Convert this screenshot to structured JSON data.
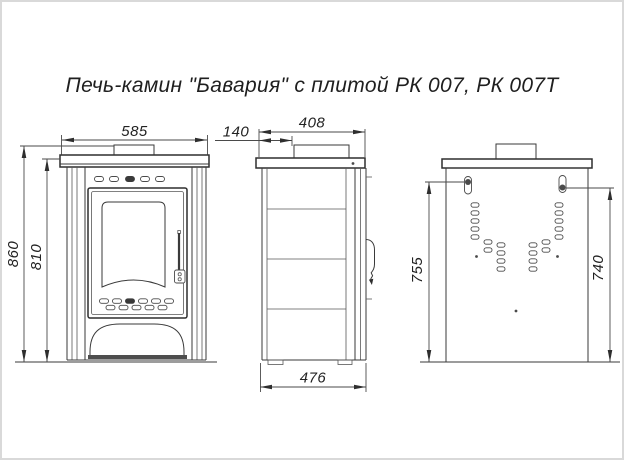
{
  "title": "Печь-камин \"Бавария\" с плитой РК 007, РК 007Т",
  "drawing": {
    "front": {
      "width_top": "585",
      "height_total": "860",
      "height_to_top_plate": "810"
    },
    "side": {
      "depth_top": "408",
      "flue_offset_from_front": "140",
      "depth_overall": "476"
    },
    "back": {
      "mount_height_left": "755",
      "mount_height_right": "740"
    }
  }
}
